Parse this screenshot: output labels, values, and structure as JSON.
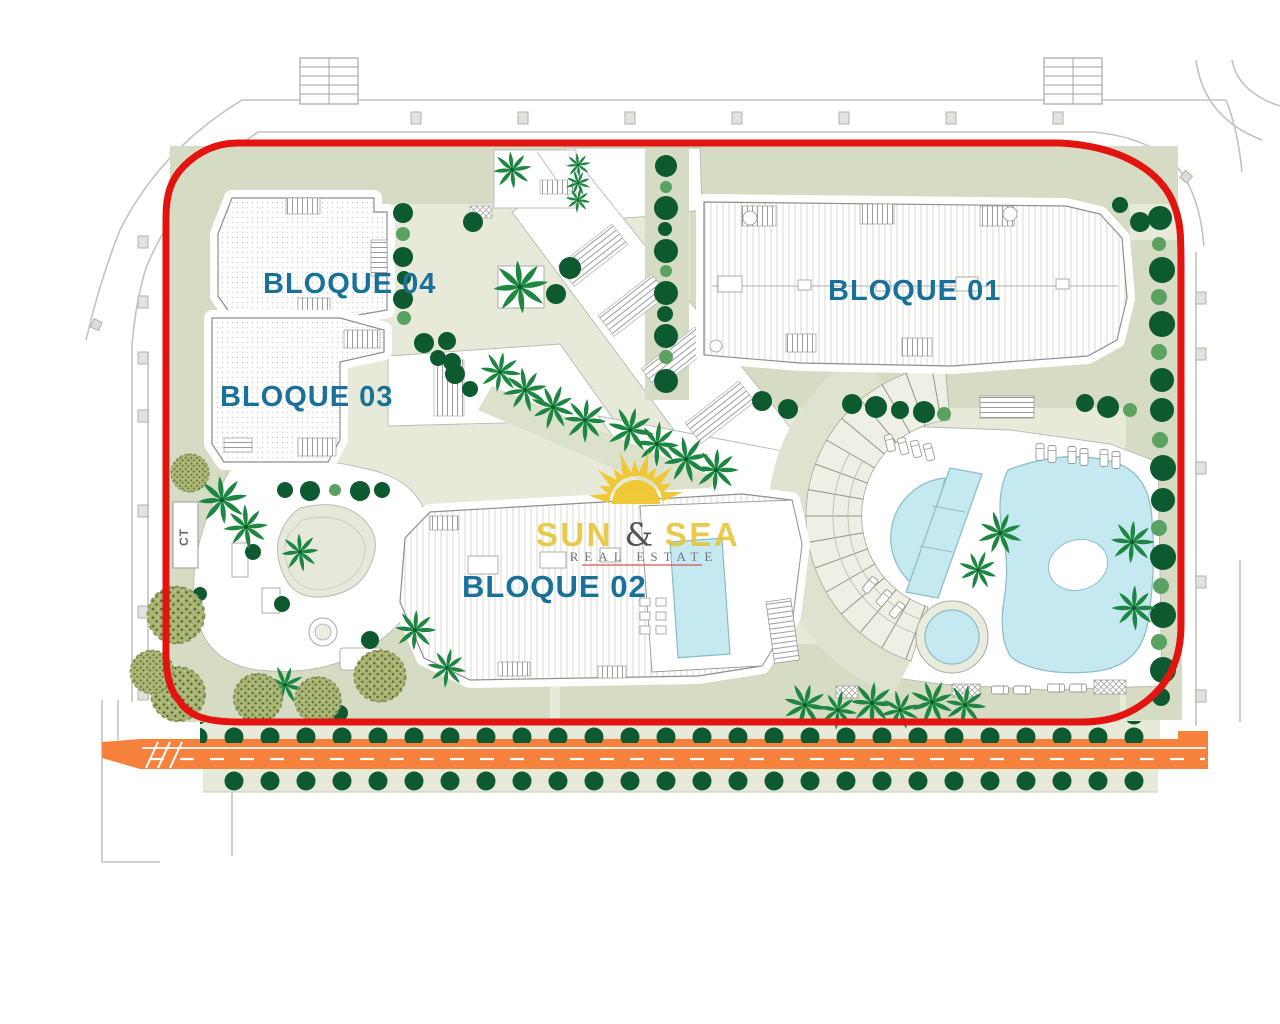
{
  "plan": {
    "labels": {
      "bloque01": "BLOQUE 01",
      "bloque02": "BLOQUE 02",
      "bloque03": "BLOQUE 03",
      "bloque04": "BLOQUE 04",
      "ct": "CT"
    },
    "logo": {
      "word1": "SUN ",
      "amp": "&",
      "word2": " SEA",
      "tagline": "REAL ESTATE"
    },
    "colors": {
      "boundary_red": "#e3140f",
      "road_orange": "#f5813d",
      "pool_blue": "#c5e9f0",
      "label_teal": "#19719a",
      "logo_yellow": "#e7c53a",
      "site_green": "#e7ead9",
      "lawn_green": "#d6dcc4",
      "tree_dark": "#0d5a30",
      "tree_light": "#5aa162",
      "palm_green": "#1d8742",
      "olive_green": "#aab573"
    }
  }
}
